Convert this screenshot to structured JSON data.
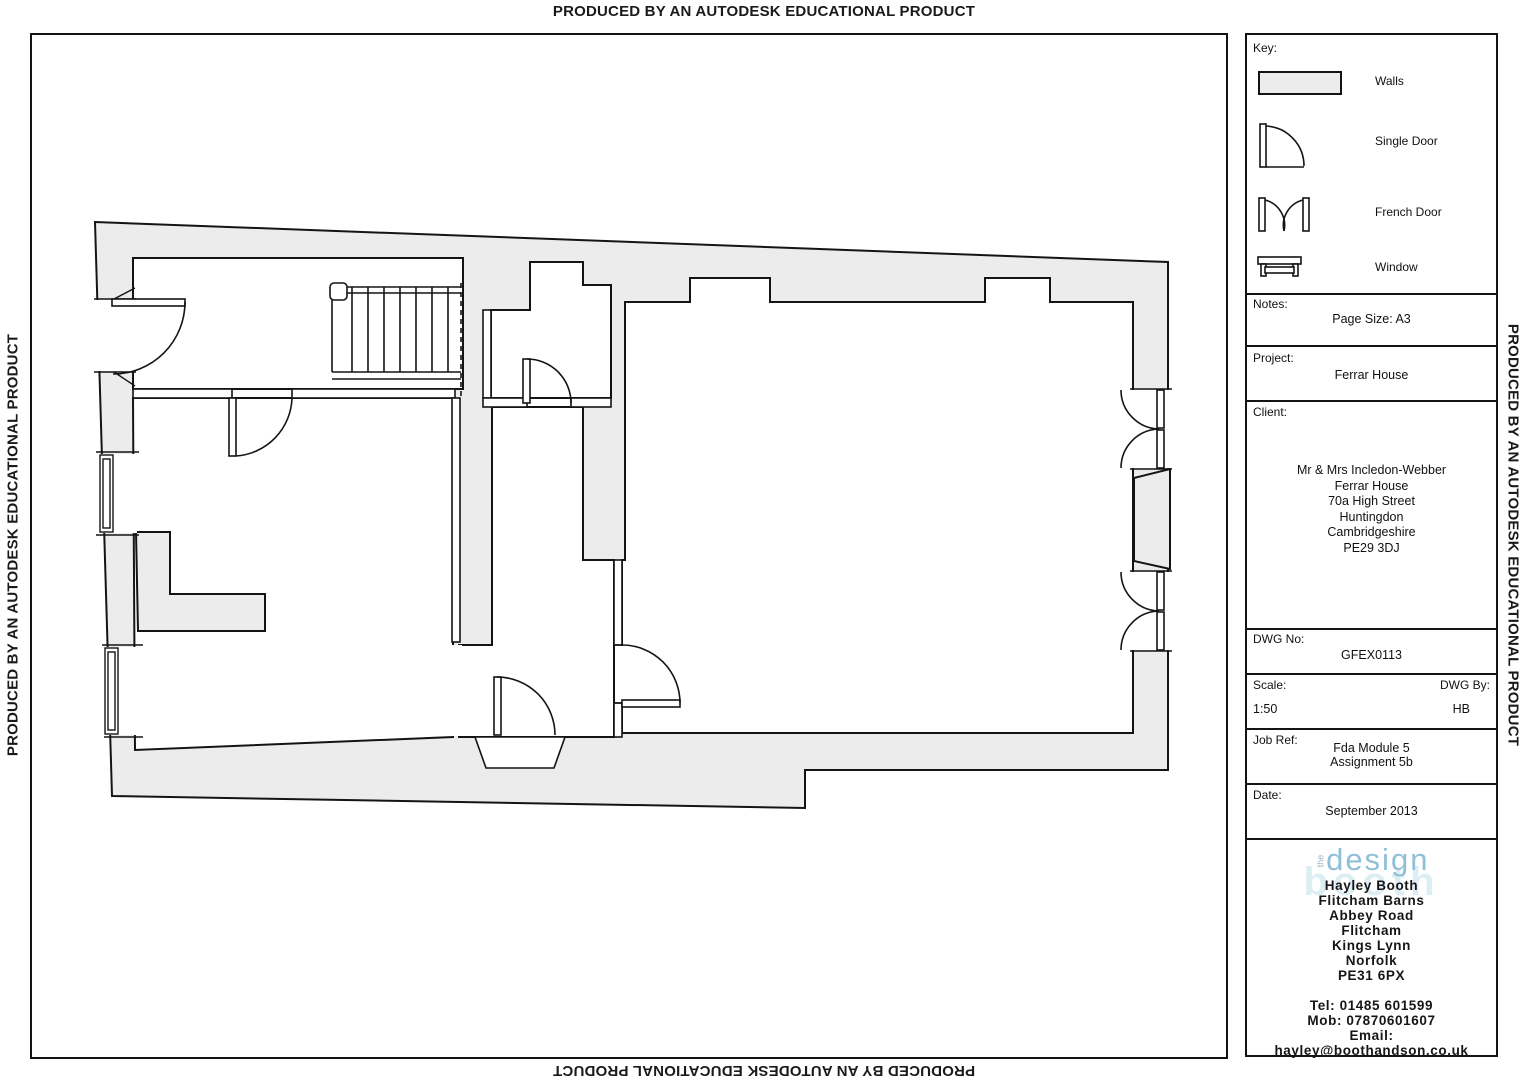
{
  "watermark": {
    "top": "PRODUCED BY AN AUTODESK EDUCATIONAL PRODUCT",
    "bottom": "PRODUCED BY AN AUTODESK EDUCATIONAL PRODUCT",
    "left": "PRODUCED BY AN AUTODESK EDUCATIONAL PRODUCT",
    "right": "PRODUCED BY AN AUTODESK EDUCATIONAL PRODUCT"
  },
  "key": {
    "title": "Key:",
    "items": [
      {
        "name": "walls",
        "label": "Walls"
      },
      {
        "name": "single-door",
        "label": "Single Door"
      },
      {
        "name": "french-door",
        "label": "French Door"
      },
      {
        "name": "window",
        "label": "Window"
      }
    ]
  },
  "notes": {
    "label": "Notes:",
    "value": "Page Size: A3"
  },
  "project": {
    "label": "Project:",
    "value": "Ferrar House"
  },
  "client": {
    "label": "Client:",
    "lines": [
      "Mr & Mrs Incledon-Webber",
      "Ferrar House",
      "70a High Street",
      "Huntingdon",
      "Cambridgeshire",
      "PE29 3DJ"
    ]
  },
  "dwg_no": {
    "label": "DWG No:",
    "value": "GFEX0113"
  },
  "scale": {
    "label": "Scale:",
    "value": "1:50"
  },
  "dwg_by": {
    "label": "DWG By:",
    "value": "HB"
  },
  "job_ref": {
    "label": "Job Ref:",
    "lines": [
      "Fda Module 5",
      "Assignment 5b"
    ]
  },
  "date": {
    "label": "Date:",
    "value": "September 2013"
  },
  "designer": {
    "logo": {
      "the": "the",
      "design": "design",
      "booth_watermark": "booth"
    },
    "lines": [
      "Hayley Booth",
      "Flitcham  Barns",
      "Abbey  Road",
      "Flitcham",
      "Kings  Lynn",
      "Norfolk",
      "PE31  6PX"
    ],
    "contact": [
      "Tel:  01485  601599",
      "Mob:  07870601607",
      "Email:",
      "hayley@boothandson.co.uk"
    ]
  },
  "colors": {
    "wall_fill": "#ececec",
    "line": "#141414",
    "logo_blue": "#8fc0d8",
    "logo_faded": "#dceef4"
  }
}
